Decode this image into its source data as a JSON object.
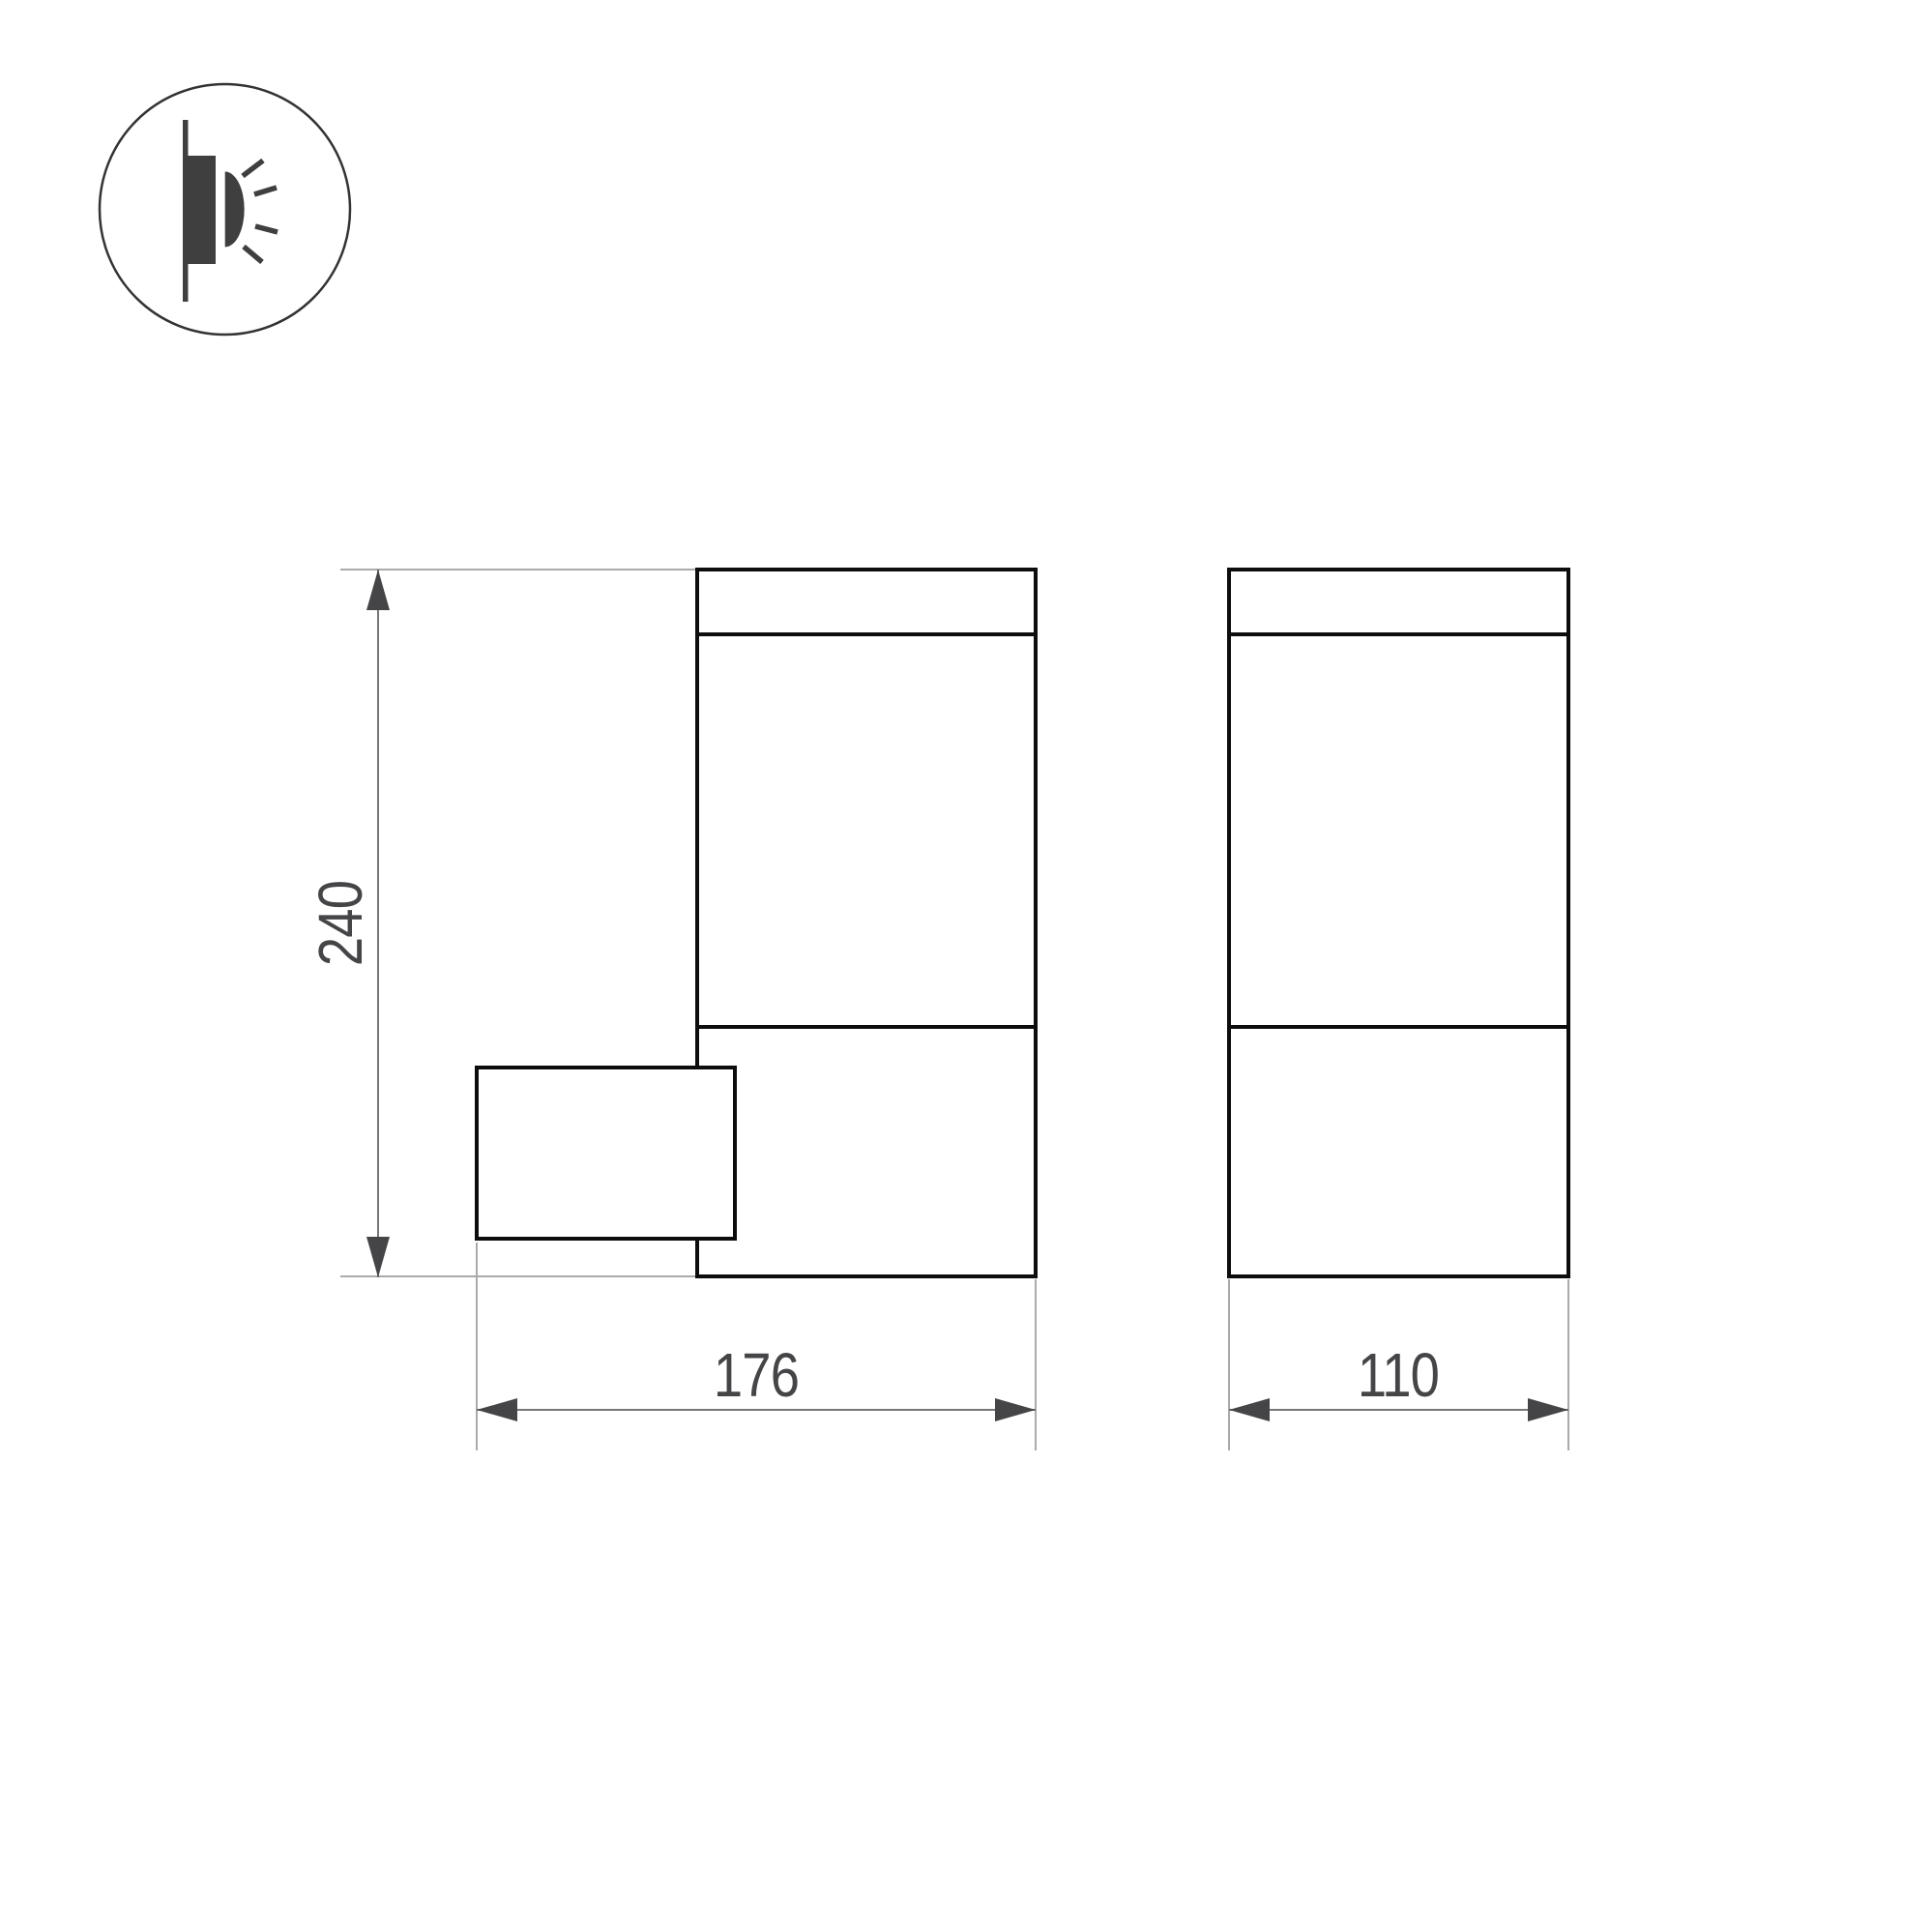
{
  "drawing": {
    "icon": {
      "name": "wall-lamp-side-emission",
      "description": "wall-mounted luminaire emitting light sideways"
    },
    "dims": {
      "height": {
        "value": "240",
        "orientation": "vertical"
      },
      "depth": {
        "value": "176",
        "orientation": "horizontal"
      },
      "width": {
        "value": "110",
        "orientation": "horizontal"
      }
    },
    "colors": {
      "outline": "#0d0d0d",
      "extension_line": "#aaaaaa",
      "dimension_line": "#777777",
      "annotation": "#454548",
      "background": "#ffffff"
    }
  }
}
